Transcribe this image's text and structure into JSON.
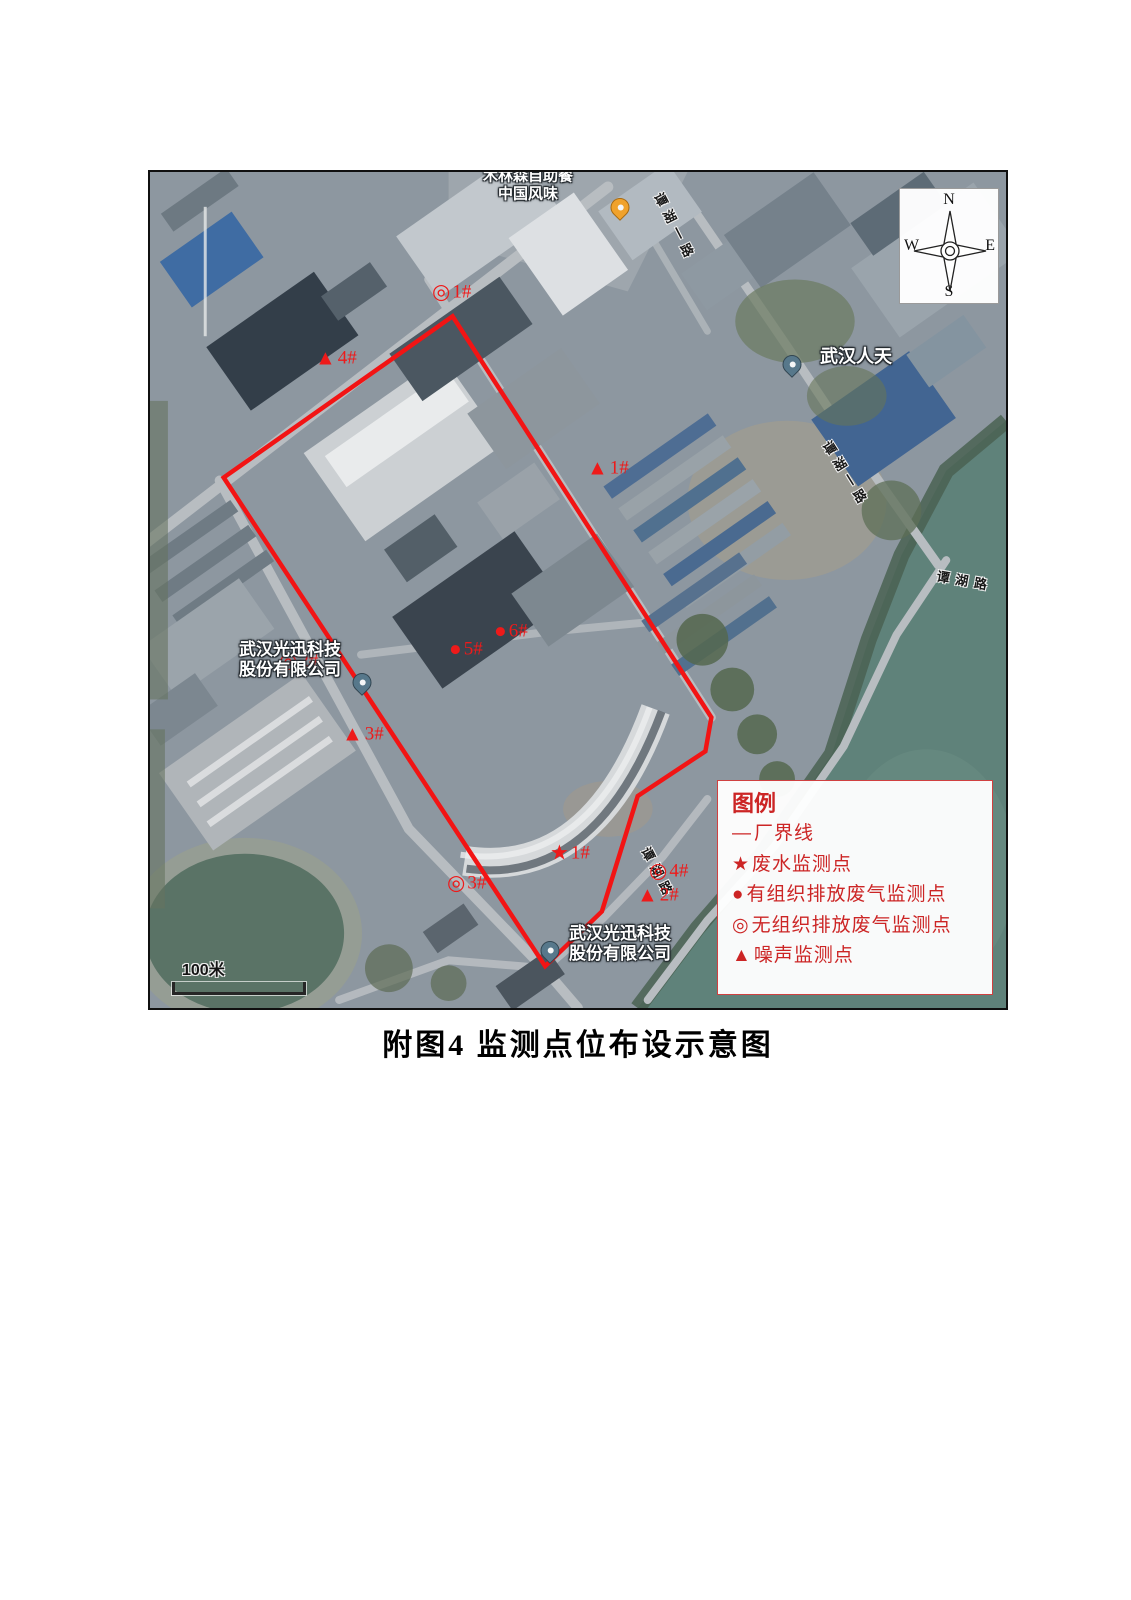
{
  "caption": "附图4 监测点位布设示意图",
  "map": {
    "compass": {
      "north": "N",
      "south": "S",
      "east": "E",
      "west": "W"
    },
    "scale_bar": "100米",
    "legend": {
      "title": "图例",
      "items": [
        {
          "symbol": "—",
          "label": "厂界线"
        },
        {
          "symbol": "★",
          "label": "废水监测点"
        },
        {
          "symbol": "●",
          "label": "有组织排放废气监测点"
        },
        {
          "symbol": "◎",
          "label": "无组织排放废气监测点"
        },
        {
          "symbol": "▲",
          "label": "噪声监测点"
        }
      ]
    },
    "markers": [
      {
        "symbol": "◎",
        "label": "1#",
        "x": 282,
        "y": 120
      },
      {
        "symbol": "▲",
        "label": "4#",
        "x": 165,
        "y": 186
      },
      {
        "symbol": "▲",
        "label": "1#",
        "x": 437,
        "y": 296
      },
      {
        "symbol": "●",
        "label": "6#",
        "x": 344,
        "y": 459
      },
      {
        "symbol": "●",
        "label": "5#",
        "x": 299,
        "y": 477
      },
      {
        "symbol": "◎",
        "label": "2#",
        "x": 129,
        "y": 489
      },
      {
        "symbol": "▲",
        "label": "3#",
        "x": 192,
        "y": 562
      },
      {
        "symbol": "★",
        "label": "1#",
        "x": 400,
        "y": 681
      },
      {
        "symbol": "◎",
        "label": "3#",
        "x": 297,
        "y": 711
      },
      {
        "symbol": "◎",
        "label": "4#",
        "x": 499,
        "y": 699
      },
      {
        "symbol": "▲",
        "label": "2#",
        "x": 487,
        "y": 723
      }
    ],
    "place_labels": [
      {
        "lines": [
          "木林森自助餐",
          "中国风味"
        ],
        "x": 378,
        "y": 13,
        "size": 15
      },
      {
        "lines": [
          "武汉人天"
        ],
        "x": 706,
        "y": 185,
        "size": 18
      },
      {
        "lines": [
          "武汉光迅科技",
          "股份有限公司"
        ],
        "x": 140,
        "y": 488,
        "size": 17
      },
      {
        "lines": [
          "武汉光迅科技",
          "股份有限公司"
        ],
        "x": 470,
        "y": 772,
        "size": 17
      }
    ],
    "road_labels": [
      {
        "text": "谭湖一路",
        "x": 526,
        "y": 55,
        "rot": 63
      },
      {
        "text": "谭湖一路",
        "x": 697,
        "y": 302,
        "rot": 58
      },
      {
        "text": "谭湖路",
        "x": 815,
        "y": 408,
        "rot": 10
      },
      {
        "text": "谭湖路",
        "x": 509,
        "y": 701,
        "rot": 63
      }
    ],
    "pins": [
      {
        "kind": "place",
        "x": 642,
        "y": 202
      },
      {
        "kind": "place",
        "x": 212,
        "y": 520
      },
      {
        "kind": "place",
        "x": 400,
        "y": 788
      },
      {
        "kind": "restaurant",
        "x": 470,
        "y": 45
      }
    ],
    "colors": {
      "boundary": "#f21414",
      "marker": "#ee1a1a",
      "legend_text": "#cc2525"
    }
  }
}
